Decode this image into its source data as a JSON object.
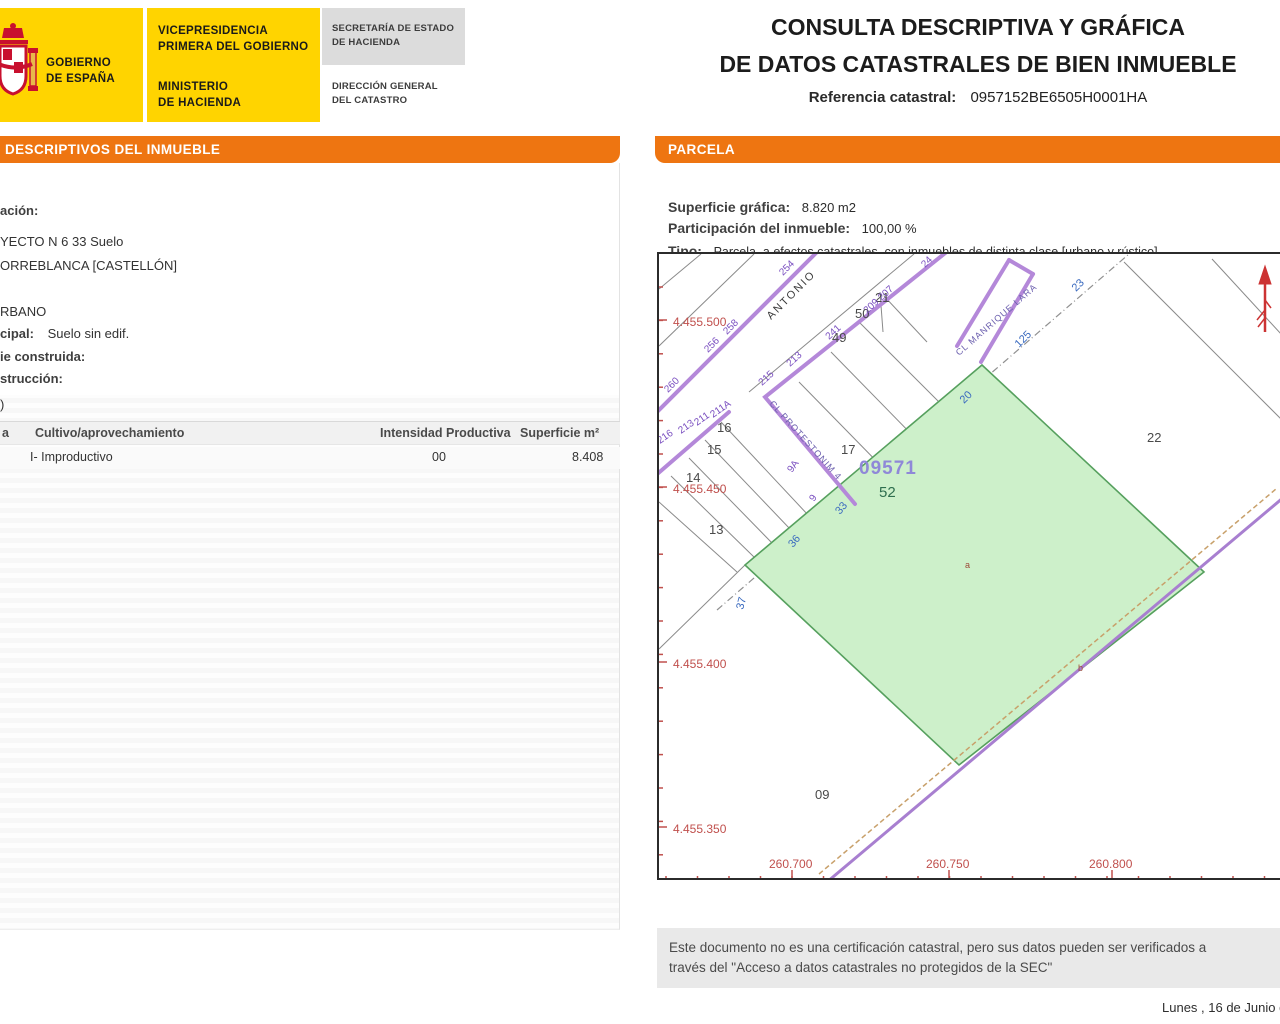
{
  "colors": {
    "brand_yellow": "#ffd400",
    "accent_orange": "#ee7511",
    "parcel_green_fill": "#cdf0ca",
    "parcel_green_stroke": "#56a05e",
    "street_purple": "#b488d9",
    "coord_red": "#c0504d",
    "north_arrow_red": "#cc3333"
  },
  "header": {
    "logo": {
      "gov_line1": "GOBIERNO",
      "gov_line2": "DE ESPAÑA",
      "dept1_line1": "VICEPRESIDENCIA",
      "dept1_line2": "PRIMERA DEL GOBIERNO",
      "dept2_line1": "MINISTERIO",
      "dept2_line2": "DE HACIENDA",
      "dept3_line1": "SECRETARÍA DE ESTADO",
      "dept3_line2": "DE HACIENDA",
      "dept4_line1": "DIRECCIÓN GENERAL",
      "dept4_line2": "DEL CATASTRO"
    },
    "title_line1": "CONSULTA DESCRIPTIVA Y GRÁFICA",
    "title_line2": "DE DATOS CATASTRALES DE BIEN INMUEBLE",
    "ref_label": "Referencia catastral:",
    "ref_value": "0957152BE6505H0001HA"
  },
  "left_panel": {
    "header": "DESCRIPTIVOS DEL INMUEBLE",
    "line_localizacion_label": "ación:",
    "line_address1": "YECTO N 6 33 Suelo",
    "line_address2": "ORREBLANCA [CASTELLÓN]",
    "line_clase": "RBANO",
    "line_uso_label": "cipal:",
    "line_uso_value": "Suelo sin edif.",
    "line_superficie_label": "ie construida:",
    "line_anio_label": "strucción:",
    "line_paren": ")",
    "table": {
      "col0": "a",
      "col1": "Cultivo/aprovechamiento",
      "col2": "Intensidad Productiva",
      "col3": "Superficie m²",
      "row0_c1": "I- Improductivo",
      "row0_c2": "00",
      "row0_c3": "8.408"
    }
  },
  "right_panel": {
    "header": "PARCELA",
    "superficie_label": "Superficie gráfica:",
    "superficie_value": "8.820 m2",
    "participacion_label": "Participación del inmueble:",
    "participacion_value": "100,00 %",
    "tipo_label": "Tipo:",
    "tipo_value": "Parcela, a efectos catastrales, con inmuebles de distinta clase [urbano y rústico]"
  },
  "map": {
    "labels": [
      {
        "cls": "ml-redcoord",
        "text": "4.455.500",
        "x": 14,
        "y": 72,
        "rot": 0
      },
      {
        "cls": "ml-redcoord",
        "text": "4.455.450",
        "x": 14,
        "y": 239,
        "rot": 0
      },
      {
        "cls": "ml-redcoord",
        "text": "4.455.400",
        "x": 14,
        "y": 414,
        "rot": 0
      },
      {
        "cls": "ml-redcoord",
        "text": "4.455.350",
        "x": 14,
        "y": 579,
        "rot": 0
      },
      {
        "cls": "ml-redcoord",
        "text": "260.700",
        "x": 110,
        "y": 614,
        "rot": 0
      },
      {
        "cls": "ml-redcoord",
        "text": "260.750",
        "x": 267,
        "y": 614,
        "rot": 0
      },
      {
        "cls": "ml-redcoord",
        "text": "260.800",
        "x": 430,
        "y": 614,
        "rot": 0
      },
      {
        "cls": "ml-parcel",
        "text": "21",
        "x": 216,
        "y": 48,
        "rot": 0
      },
      {
        "cls": "ml-parcel",
        "text": "50",
        "x": 196,
        "y": 64,
        "rot": 0
      },
      {
        "cls": "ml-parcel",
        "text": "49",
        "x": 173,
        "y": 88,
        "rot": 0
      },
      {
        "cls": "ml-parcel",
        "text": "17",
        "x": 182,
        "y": 200,
        "rot": 0
      },
      {
        "cls": "ml-parcel",
        "text": "16",
        "x": 58,
        "y": 178,
        "rot": 0
      },
      {
        "cls": "ml-parcel",
        "text": "15",
        "x": 48,
        "y": 200,
        "rot": 0
      },
      {
        "cls": "ml-parcel",
        "text": "14",
        "x": 27,
        "y": 228,
        "rot": 0
      },
      {
        "cls": "ml-parcel",
        "text": "13",
        "x": 50,
        "y": 280,
        "rot": 0
      },
      {
        "cls": "ml-parcel",
        "text": "22",
        "x": 488,
        "y": 188,
        "rot": 0
      },
      {
        "cls": "ml-parcel",
        "text": "09",
        "x": 156,
        "y": 545,
        "rot": 0
      },
      {
        "cls": "ml-parcel52",
        "text": "52",
        "x": 220,
        "y": 243,
        "rot": 0
      },
      {
        "cls": "ml-bigref",
        "text": "09571",
        "x": 200,
        "y": 220,
        "rot": 0
      },
      {
        "cls": "ml-blue",
        "text": "36",
        "x": 134,
        "y": 294,
        "rot": -50
      },
      {
        "cls": "ml-blue",
        "text": "33",
        "x": 181,
        "y": 261,
        "rot": -50
      },
      {
        "cls": "ml-blue",
        "text": "37",
        "x": 84,
        "y": 356,
        "rot": -75
      },
      {
        "cls": "ml-blue",
        "text": "20",
        "x": 305,
        "y": 150,
        "rot": -45
      },
      {
        "cls": "ml-blue",
        "text": "23",
        "x": 417,
        "y": 38,
        "rot": -45
      },
      {
        "cls": "ml-blue",
        "text": "125",
        "x": 360,
        "y": 94,
        "rot": -45
      },
      {
        "cls": "ml-purple",
        "text": "254",
        "x": 124,
        "y": 22,
        "rot": -45
      },
      {
        "cls": "ml-purple",
        "text": "258",
        "x": 68,
        "y": 81,
        "rot": -45
      },
      {
        "cls": "ml-purple",
        "text": "256",
        "x": 49,
        "y": 99,
        "rot": -45
      },
      {
        "cls": "ml-purple",
        "text": "260",
        "x": 9,
        "y": 139,
        "rot": -45
      },
      {
        "cls": "ml-purple",
        "text": "24",
        "x": 266,
        "y": 14,
        "rot": -45
      },
      {
        "cls": "ml-purple",
        "text": "209 207",
        "x": 208,
        "y": 60,
        "rot": -42
      },
      {
        "cls": "ml-purple",
        "text": "241",
        "x": 170,
        "y": 86,
        "rot": -42
      },
      {
        "cls": "ml-purple",
        "text": "213",
        "x": 131,
        "y": 113,
        "rot": -42
      },
      {
        "cls": "ml-purple",
        "text": "215",
        "x": 103,
        "y": 132,
        "rot": -42
      },
      {
        "cls": "ml-purple",
        "text": "211A",
        "x": 54,
        "y": 164,
        "rot": -35
      },
      {
        "cls": "ml-purple",
        "text": "211",
        "x": 38,
        "y": 172,
        "rot": -35
      },
      {
        "cls": "ml-purple",
        "text": "213",
        "x": 22,
        "y": 180,
        "rot": -35
      },
      {
        "cls": "ml-purple",
        "text": "216",
        "x": 1,
        "y": 190,
        "rot": -35
      },
      {
        "cls": "ml-purple",
        "text": "9A",
        "x": 133,
        "y": 219,
        "rot": -55
      },
      {
        "cls": "ml-purple",
        "text": "9",
        "x": 155,
        "y": 248,
        "rot": -55
      },
      {
        "cls": "ml-street",
        "text": "ANTONIO",
        "x": 112,
        "y": 66,
        "rot": -45
      },
      {
        "cls": "ml-streetp",
        "text": "CL MANRIQUE LARA",
        "x": 300,
        "y": 102,
        "rot": -41
      },
      {
        "cls": "ml-streetp",
        "text": "CL PROTESTONIM 4",
        "x": 110,
        "y": 150,
        "rot": 48
      },
      {
        "cls": "ml-marker",
        "text": "a",
        "x": 306,
        "y": 314,
        "rot": 0
      },
      {
        "cls": "ml-marker",
        "text": "b",
        "x": 419,
        "y": 417,
        "rot": 0
      }
    ]
  },
  "footer": {
    "disclaimer_line1": "Este documento no es una certificación catastral, pero sus datos pueden ser verificados a",
    "disclaimer_line2": "través del \"Acceso a datos catastrales no protegidos de la SEC\"",
    "date": "Lunes , 16 de Junio de 2"
  }
}
